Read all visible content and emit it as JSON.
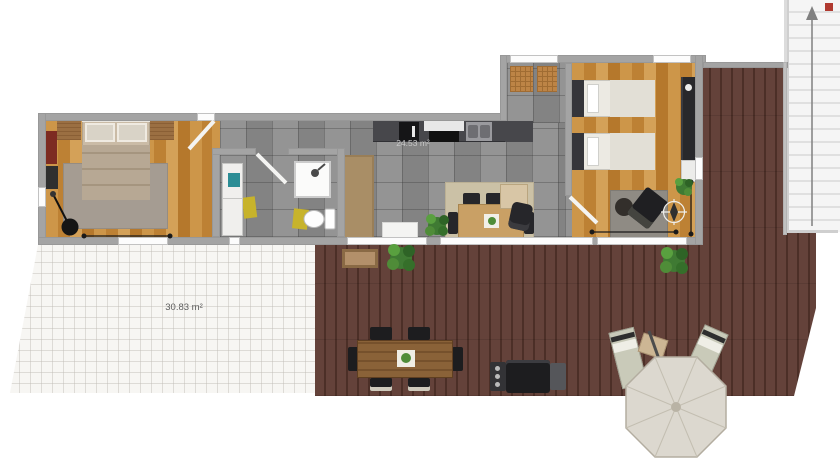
{
  "labels": {
    "terrace_area": "30.83 m²",
    "interior_area": "24.53 m²"
  },
  "rooms": [
    "master-bedroom",
    "bathroom",
    "hallway",
    "kitchen-living-room",
    "entry-hall",
    "bedroom-2",
    "white-tile-terrace",
    "wood-deck",
    "staircase"
  ],
  "furniture": [
    "double-bed",
    "nightstand",
    "red-cabinet",
    "tv-panel",
    "floor-lamp",
    "bedroom-rug",
    "vanity-sink",
    "toilet",
    "shower-stall",
    "bath-mat",
    "kitchen-counter",
    "oven",
    "cooktop",
    "double-sink",
    "runner-rug",
    "dining-table",
    "dining-chair",
    "dining-rug",
    "houseplant",
    "doormat",
    "entry-mat",
    "desk",
    "office-chair",
    "single-bed",
    "wardrobe",
    "dresser",
    "lounge-chair",
    "ottoman",
    "compass-rose",
    "planter-box",
    "outdoor-dining-table",
    "outdoor-chair",
    "bbq-grill",
    "sun-lounger",
    "side-table",
    "patio-umbrella",
    "stairs-up-arrow",
    "stairs-marker"
  ],
  "icons": {
    "compass": "compass-rose-icon",
    "stairs_arrow": "up-arrow-icon",
    "shower": "shower-head-icon"
  },
  "colors": {
    "wood_floor": "#c68c3e",
    "tile_floor": "#8d8d8d",
    "deck_wood": "#5d3c33",
    "terrace_tile": "#f7f6f3",
    "wall": "#a4a4a4",
    "sink_teal": "#2c8d95",
    "bath_mat_yellow": "#c7b32b",
    "stairs_marker_red": "#b03a30",
    "umbrella": "#dcd8cf"
  }
}
